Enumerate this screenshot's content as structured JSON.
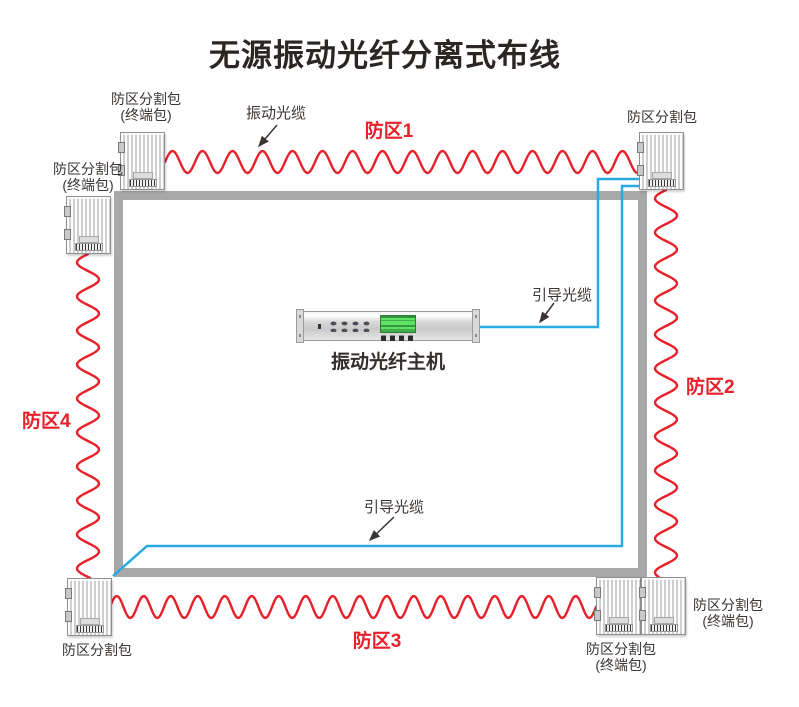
{
  "title": "无源振动光纤分离式布线",
  "colors": {
    "zone_red": "#e8202a",
    "cable_blue": "#29abe2",
    "wall_gray": "#a8a8a8",
    "lcd_green": "#5fe166",
    "label_dark": "#3a3532"
  },
  "zones": [
    {
      "label": "防区1"
    },
    {
      "label": "防区2"
    },
    {
      "label": "防区3"
    },
    {
      "label": "防区4"
    }
  ],
  "annotations": {
    "vibration_cable": "振动光缆",
    "guide_cable_top": "引导光缆",
    "guide_cable_bottom": "引导光缆"
  },
  "host": {
    "label": "振动光纤主机"
  },
  "boxes": {
    "top_left": {
      "line1": "防区分割包",
      "line2": "(终端包)"
    },
    "left": {
      "line1": "防区分割包",
      "line2": "(终端包)"
    },
    "top_right": {
      "line1": "防区分割包"
    },
    "bottom_left": {
      "line1": "防区分割包"
    },
    "bottom_right_inner": {
      "line1": "防区分割包",
      "line2": "(终端包)"
    },
    "bottom_right_outer": {
      "line1": "防区分割包",
      "line2": "(终端包)"
    }
  }
}
